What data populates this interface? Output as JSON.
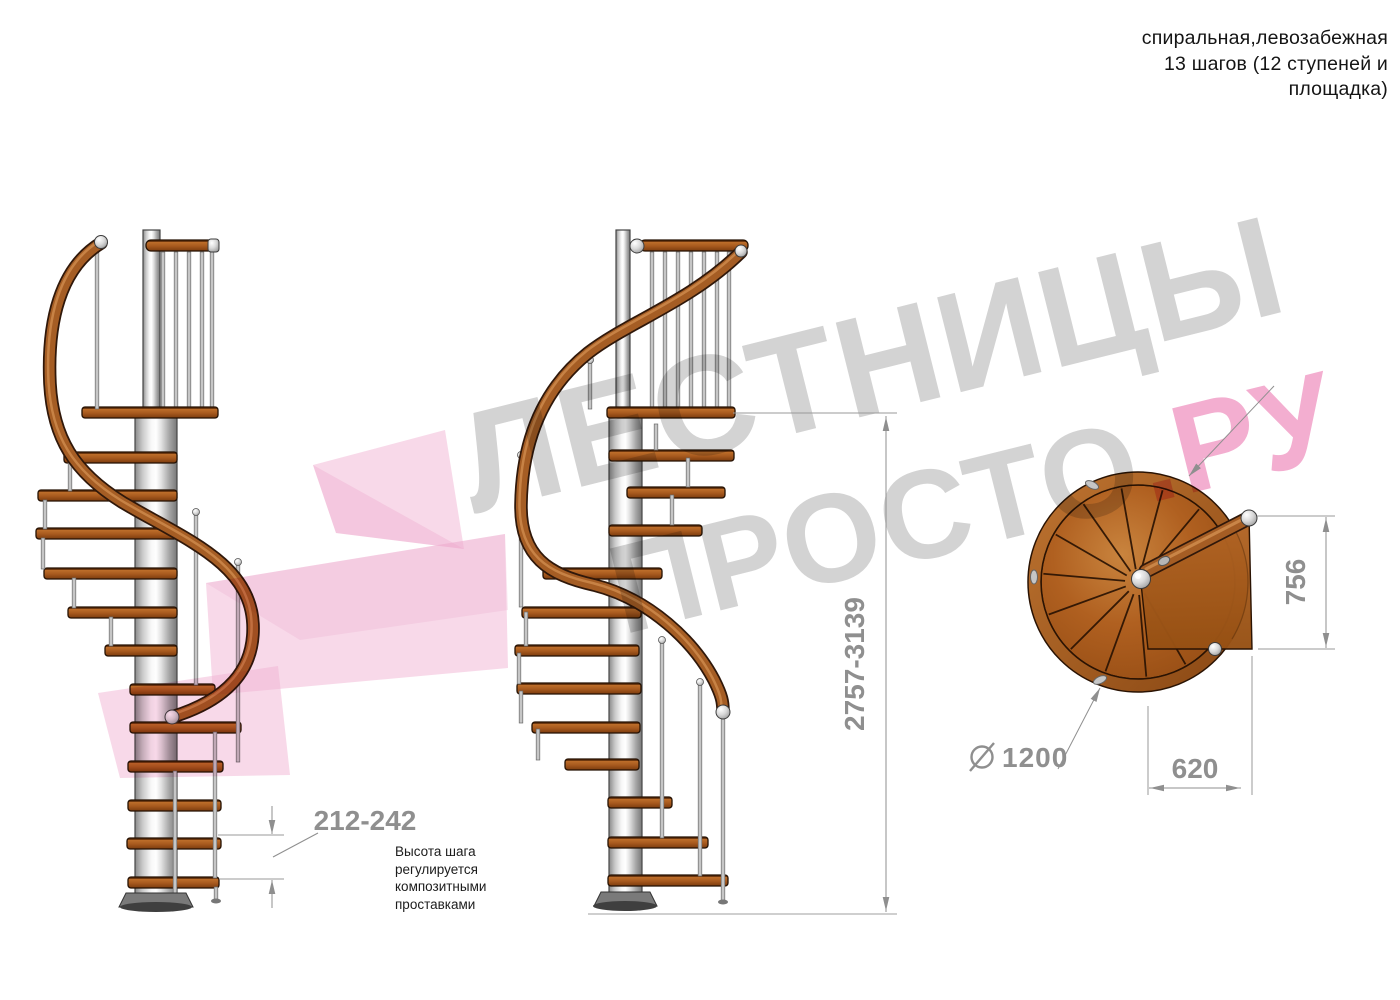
{
  "header": {
    "lines": [
      "спиральная,левозабежная",
      "13 шагов (12 ступеней и",
      "площадка)"
    ]
  },
  "watermark": {
    "line1": "ЛЕСТНИЦЫ",
    "line2_gray": "ПРОСТО",
    "line2_pink": ".РУ",
    "gray_color": "#d3d3d3",
    "pink_color": "#f3aed0",
    "arrow_color": "#f2b4d3"
  },
  "dimensions": {
    "height_range": "2757-3139",
    "step_height_range": "212-242",
    "platform_depth": "756",
    "platform_width": "620",
    "diameter_symbol": "⌀",
    "diameter_value": "1200"
  },
  "note": {
    "lines": [
      "Высота шага",
      "регулируется",
      "композитными",
      "проставками"
    ]
  },
  "colors": {
    "wood": "#a85a1e",
    "wood_dark": "#2a1303",
    "metal": "#d9d9d9",
    "dimension_gray": "#8f8f8f",
    "note_text": "#1c1c1c"
  }
}
